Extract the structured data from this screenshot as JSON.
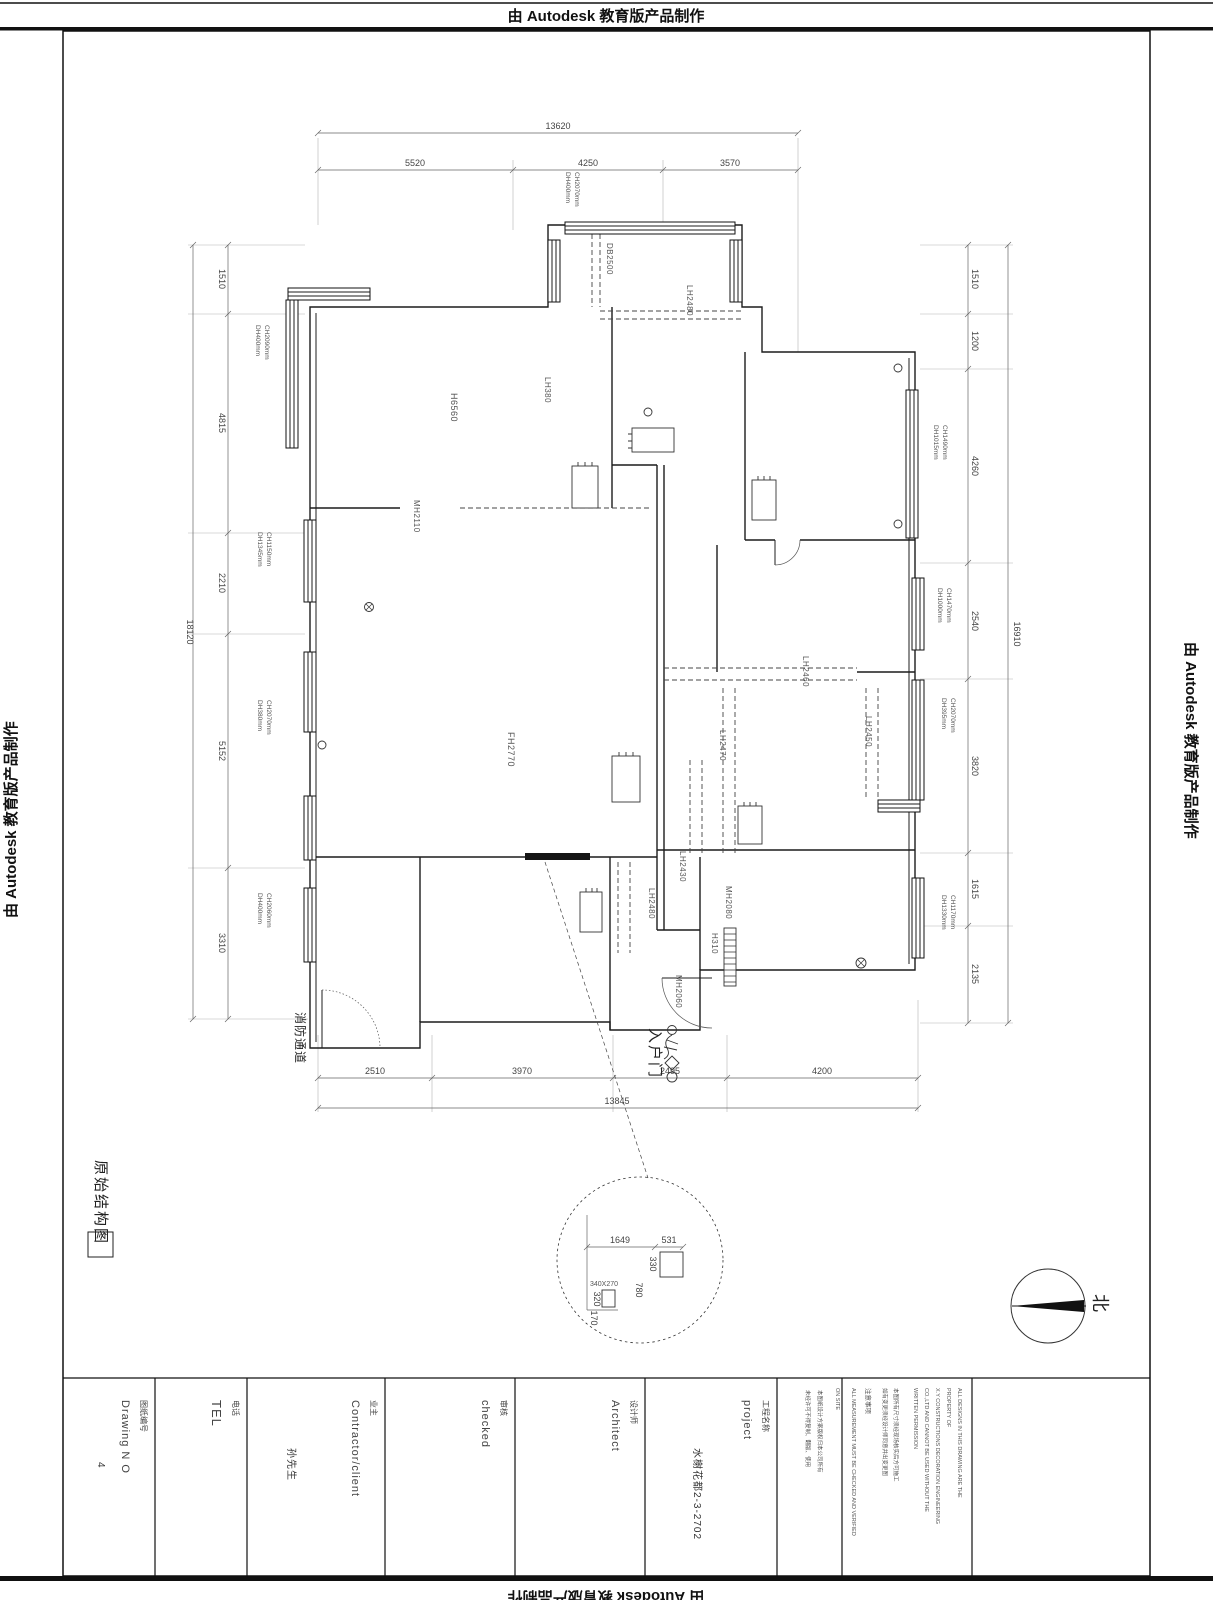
{
  "watermarks": {
    "top": "由 Autodesk 教育版产品制作",
    "left": "由 Autodesk 教育版产品制作",
    "right": "由 Autodesk 教育版产品制作",
    "bottom": "由 Autodesk 教育版产品制作"
  },
  "plan": {
    "title": "原始结构图",
    "north_label": "北",
    "entry_label": "入户门",
    "fire_label": "消防通道",
    "dims": {
      "top_total": "13620",
      "top": [
        "5520",
        "4250",
        "3570"
      ],
      "left_total": "18120",
      "left": [
        "1510",
        "4815",
        "2210",
        "5152",
        "3310"
      ],
      "right_total": "16910",
      "right": [
        "1510",
        "1200",
        "4260",
        "2540",
        "3820",
        "1615",
        "2135"
      ],
      "bottom_total": "13845",
      "bottom": [
        "2510",
        "3970",
        "2495",
        "4200"
      ]
    },
    "openings": [
      {
        "ch": "CH2070mm",
        "dh": "DH400mm"
      },
      {
        "ch": "CH2090mm",
        "dh": "DH400mm"
      },
      {
        "ch": "CH1150mm",
        "dh": "DH1345mm"
      },
      {
        "ch": "CH2070mm",
        "dh": "DH380mm"
      },
      {
        "ch": "CH2060mm",
        "dh": "DH400mm"
      },
      {
        "ch": "CH1490mm",
        "dh": "DH1015mm"
      },
      {
        "ch": "CH1470mm",
        "dh": "DH1000mm"
      },
      {
        "ch": "CH2070mm",
        "dh": "DH395mm"
      },
      {
        "ch": "CH1170mm",
        "dh": "DH1330mm"
      }
    ],
    "rooms": [
      "H6560",
      "LH380",
      "MH2110",
      "DB2500",
      "LH2480",
      "FH2770",
      "LH2460",
      "LH2470",
      "LH2450",
      "LH2430",
      "LH2480",
      "MH2080",
      "H310",
      "MH2060"
    ],
    "detail": [
      "1649",
      "531",
      "330",
      "340X270",
      "320",
      "170",
      "780"
    ]
  },
  "title_block": {
    "drawing_no_cn": "图纸编号",
    "drawing_no_en": "Drawing N O",
    "drawing_no_value": "4",
    "tel_cn": "电话",
    "tel_en": "TEL",
    "client_cn": "业主",
    "client_en": "Contractor/client",
    "client_value": "孙先生",
    "checked_cn": "审核",
    "checked_en": "checked",
    "architect_cn": "设计师",
    "architect_en": "Architect",
    "project_cn": "工程名称",
    "project_en": "project",
    "project_value": "水榭花都2-3-2702",
    "note_cn_a": "本图纸设计方案版权归本公司所有",
    "note_cn_b": "未经许可不得复制、翻版、使用",
    "note_en_1a": "ALL DESIGNS IN THIS DRAWING ARE THE",
    "note_en_1b": "PROPERTY OF",
    "note_en_1c": "X.Y CONSTRUCTIONS DECORATION ENGINEERING",
    "note_en_1d": "CO.,LTD AND CANNOT BE USED WITHOUT THE",
    "note_en_1e": "WRITTEN PERMISSION",
    "note_cn_c": "本图所有尺寸须经现场核实后方可施工",
    "note_cn_d": "如有变更须经设计师同意并出变更图",
    "note_cn_head": "注意事项",
    "note_en_2a": "ALL MEASUREMENT MUST BE CHECKED AND VERIFIED",
    "note_en_2b": "ON SITE"
  }
}
